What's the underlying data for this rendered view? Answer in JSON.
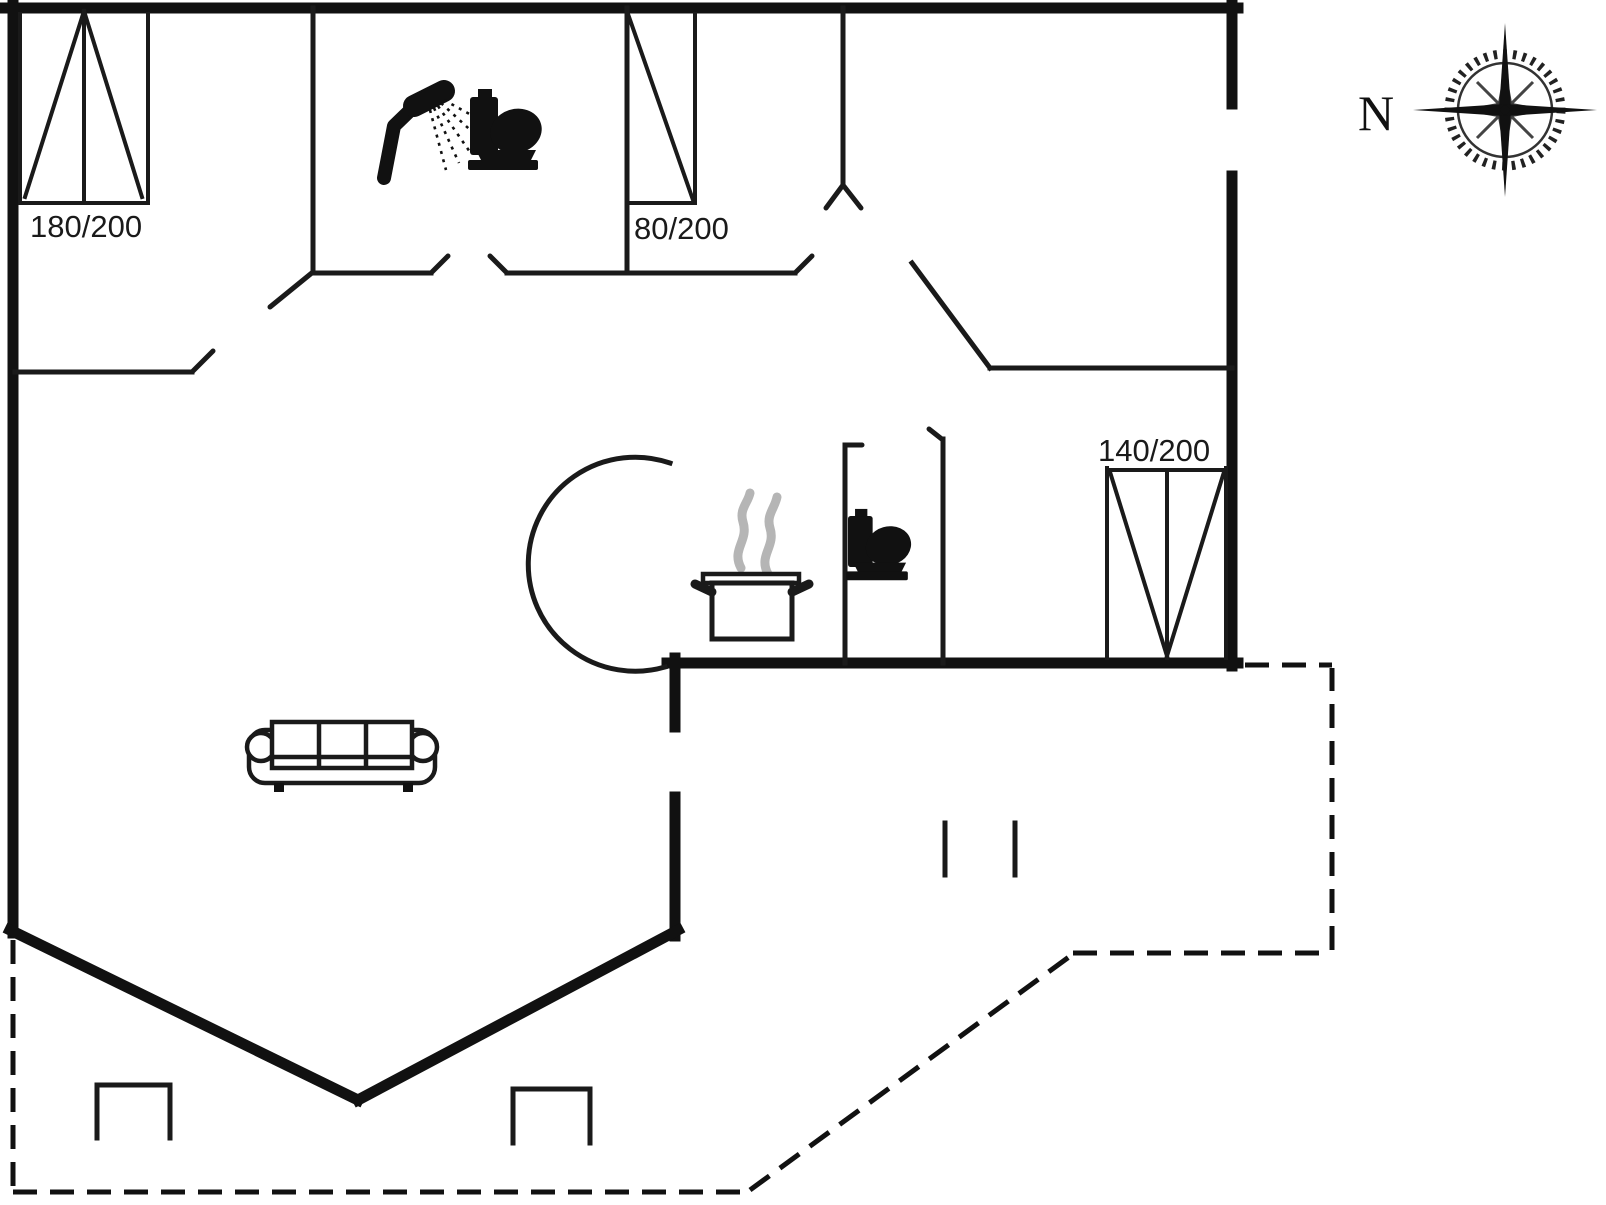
{
  "page": {
    "background": "#ffffff"
  },
  "colors": {
    "line": "#1a1a1a",
    "wall": "#111111",
    "steam": "#b5b5b5"
  },
  "windows": [
    {
      "name": "window-180x200",
      "label": "180/200"
    },
    {
      "name": "window-80x200",
      "label": "80/200"
    },
    {
      "name": "window-140x200",
      "label": "140/200"
    }
  ],
  "compass": {
    "north_label": "N"
  },
  "icons": {
    "shower": "shower-icon",
    "toilet_bathroom": "toilet-icon",
    "toilet_wc": "toilet-icon",
    "cooking_pot": "cooking-pot-icon",
    "sofa": "sofa-icon",
    "compass_rose": "compass-rose-icon"
  }
}
